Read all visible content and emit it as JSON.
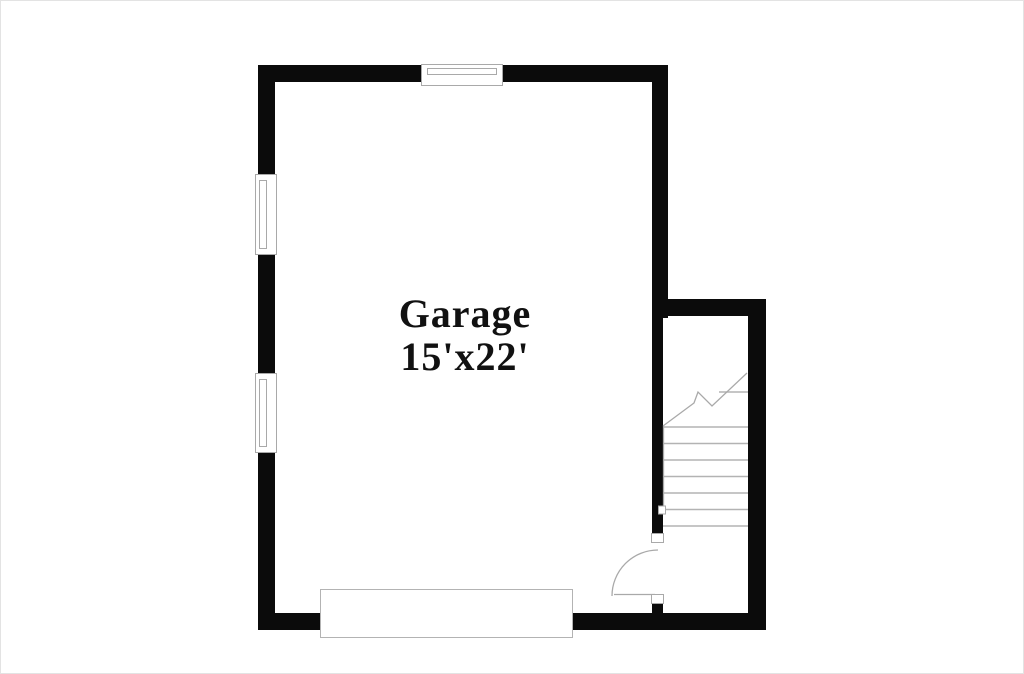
{
  "title": "Garage floor plan",
  "colors": {
    "wall": "#0b0b0b",
    "line": "#a9a9a9",
    "line2": "#b3b3b3",
    "text": "#111111",
    "bg": "#ffffff",
    "border": "#e3e3e3"
  },
  "room": {
    "name": "Garage",
    "dimensions": "15'x22'"
  },
  "features": {
    "windows": [
      "window-top-wall",
      "window-left-wall-upper",
      "window-left-wall-lower"
    ],
    "interior_door": "door-to-stairwell-with-swing-arc",
    "garage_door": "garage-door-opening-bottom-wall",
    "stairs": {
      "visible_treads": 8,
      "has_break_line": true
    }
  }
}
